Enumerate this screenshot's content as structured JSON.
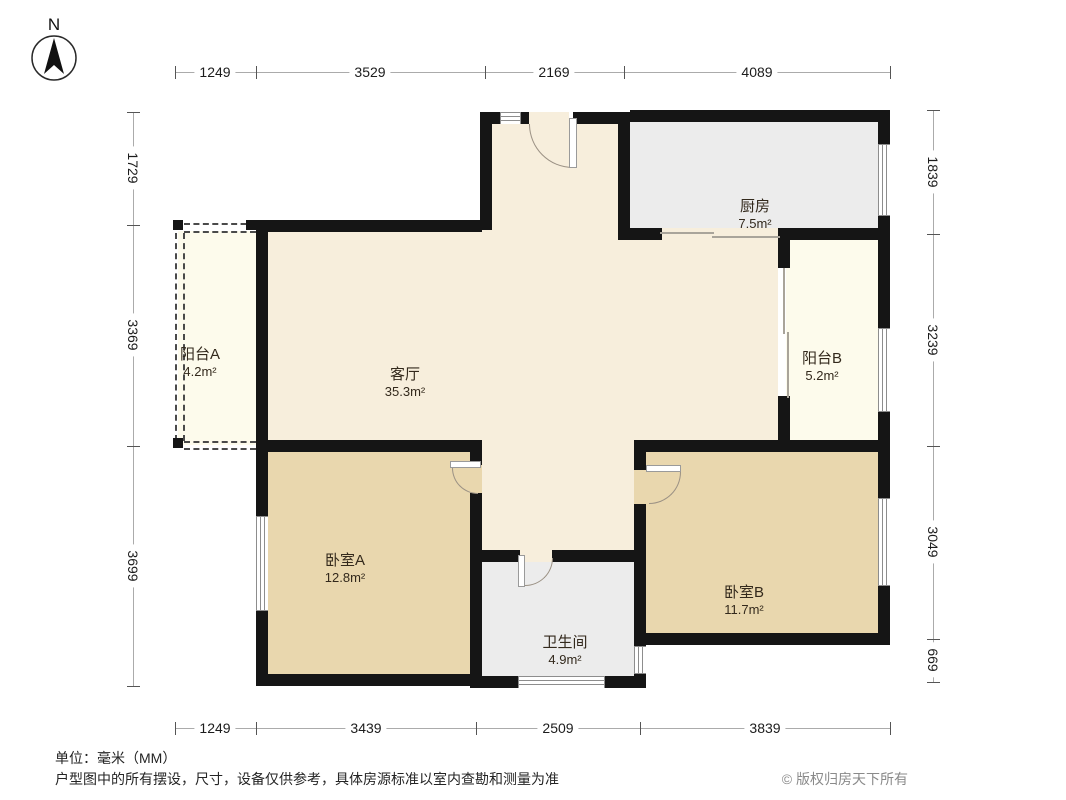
{
  "compass": {
    "label": "N"
  },
  "rooms": [
    {
      "name": "客厅",
      "area": "35.3m²"
    },
    {
      "name": "厨房",
      "area": "7.5m²"
    },
    {
      "name": "卧室A",
      "area": "12.8m²"
    },
    {
      "name": "卧室B",
      "area": "11.7m²"
    },
    {
      "name": "卫生间",
      "area": "4.9m²"
    },
    {
      "name": "阳台A",
      "area": "4.2m²"
    },
    {
      "name": "阳台B",
      "area": "5.2m²"
    }
  ],
  "dimensions_mm": {
    "top": [
      "1249",
      "3529",
      "2169",
      "4089"
    ],
    "bottom": [
      "1249",
      "3439",
      "2509",
      "3839"
    ],
    "left": [
      "1729",
      "3369",
      "3699"
    ],
    "right": [
      "1839",
      "3239",
      "3049",
      "669"
    ]
  },
  "footer": {
    "unit": "单位：毫米（MM）",
    "disclaimer": "户型图中的所有摆设，尺寸，设备仅供参考，具体房源标准以室内查勘和测量为准",
    "copyright": "© 版权归房天下所有"
  },
  "colors": {
    "wall": "#151515",
    "living": "#f7eedc",
    "bedroom": "#e9d7ae",
    "service": "#ececec",
    "balcony": "#fdfbec",
    "dim": "#1c1c1c"
  }
}
